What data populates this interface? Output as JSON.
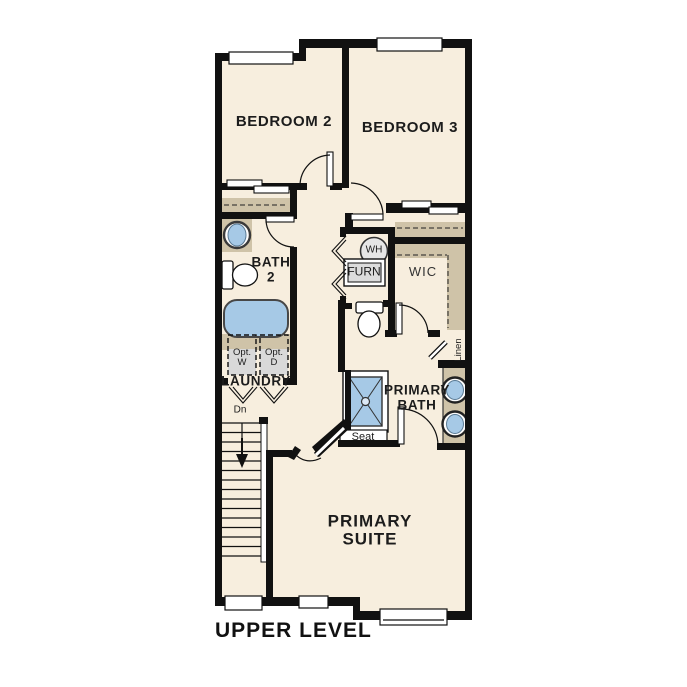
{
  "title": "UPPER LEVEL",
  "colors": {
    "background": "#ffffff",
    "wall": "#111111",
    "floor": "#f7eede",
    "cabinet_tan": "#cfc3a8",
    "fixture_blue": "#a6c9e6",
    "appliance_gray": "#dcdcdc"
  },
  "rooms": {
    "bedroom2": "BEDROOM 2",
    "bedroom3": "BEDROOM 3",
    "bath2": "BATH\n2",
    "laundry": "LAUNDRY",
    "wic": "WIC",
    "linen": "Linen",
    "primary_bath": "PRIMARY\nBATH",
    "primary_suite": "PRIMARY\nSUITE"
  },
  "fixtures": {
    "water_heater": "WH",
    "furnace": "FURN",
    "opt_washer": "Opt.\nW",
    "opt_dryer": "Opt.\nD",
    "shower_seat": "Seat",
    "stairs_down": "Dn"
  }
}
